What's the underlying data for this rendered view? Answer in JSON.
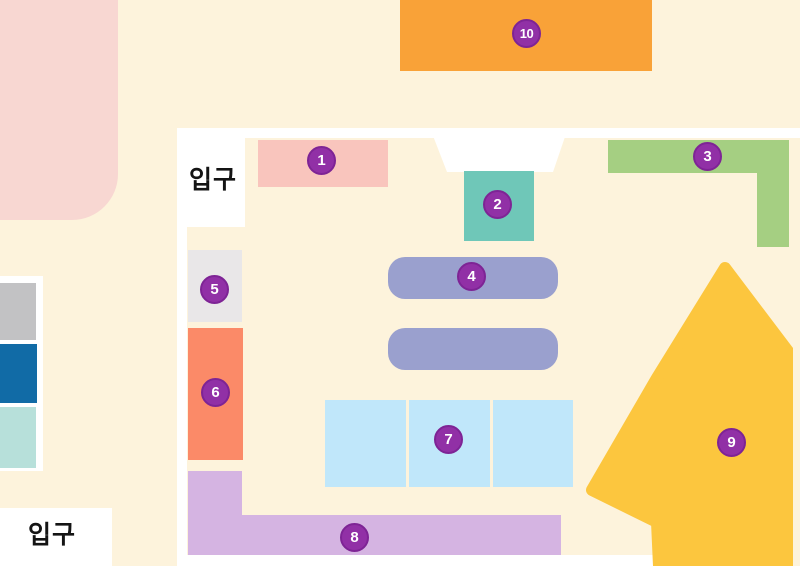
{
  "entrances": {
    "top_label": "입구",
    "bottom_label": "입구"
  },
  "zones": [
    {
      "number": "1",
      "color": "#f9c5bd"
    },
    {
      "number": "2",
      "color": "#6fc7b8"
    },
    {
      "number": "3",
      "color": "#a5cf82"
    },
    {
      "number": "4",
      "color": "#9aa0ce"
    },
    {
      "number": "5",
      "color": "#e9e7e8"
    },
    {
      "number": "6",
      "color": "#fb8a68"
    },
    {
      "number": "7",
      "color": "#c0e7fa"
    },
    {
      "number": "8",
      "color": "#d5b4e2"
    },
    {
      "number": "9",
      "color": "#fcc63e"
    },
    {
      "number": "10",
      "color": "#f9a238"
    }
  ],
  "colors": {
    "background": "#fdf3dc",
    "wall_white": "#ffffff",
    "marker_purple": "#9130a6",
    "marker_border": "#7e2495",
    "marker_number_text": "#ffffff",
    "entrance_text": "#141414",
    "outside_pink_blob": "#f8d7d2",
    "left_shelf_gray": "#c2c2c4",
    "left_shelf_blue": "#116ba6",
    "left_shelf_teal": "#b7e0da"
  }
}
